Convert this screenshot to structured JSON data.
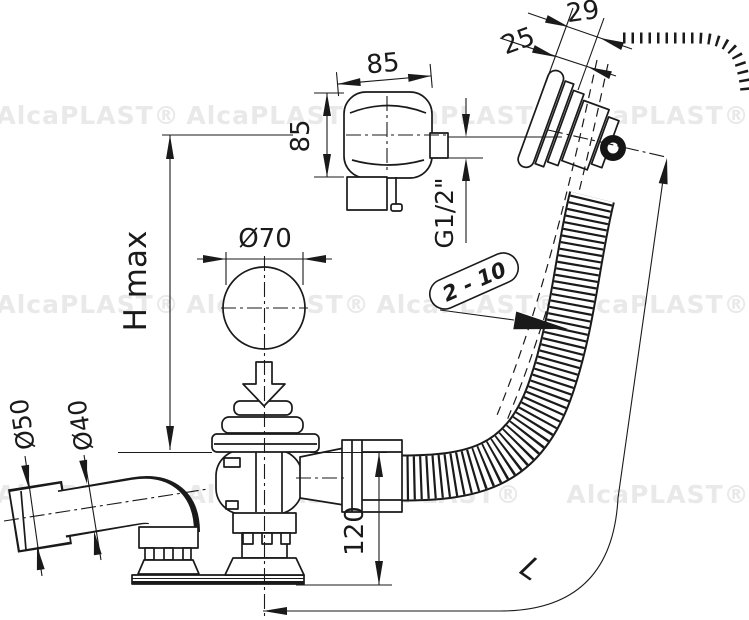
{
  "watermark": {
    "text": "AlcaPLAST®"
  },
  "labels": {
    "box_width": "85",
    "box_height": "85",
    "wall_outer": "29",
    "wall_inner": "25",
    "knob_diameter": "Ø70",
    "thread_size": "G1/2\"",
    "panel_range": "2 - 10",
    "height_max": "H max",
    "pipe_large": "Ø50",
    "pipe_small": "Ø40",
    "trap_depth": "120",
    "hose_length": "L"
  },
  "colors": {
    "line": "#1a1a1a",
    "background": "#ffffff",
    "watermark": "#e9e9e9"
  }
}
